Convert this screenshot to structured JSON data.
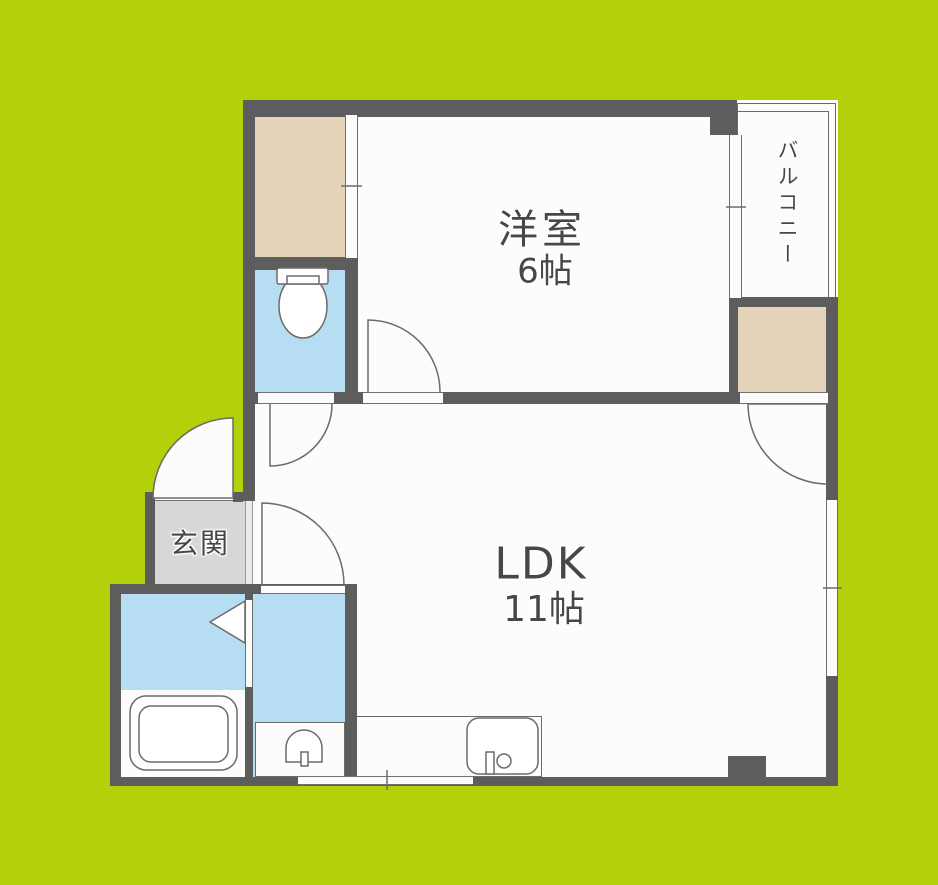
{
  "rooms": {
    "western": {
      "label": "洋室",
      "size": "6帖"
    },
    "ldk": {
      "label": "LDK",
      "size": "11帖"
    },
    "balcony": {
      "label": "バルコニー"
    },
    "entrance": {
      "label": "玄関"
    }
  },
  "fixtures": [
    "toilet",
    "bathtub",
    "washbasin",
    "kitchen-sink",
    "folding-bath-door",
    "hinged-doors",
    "sliding-closet-door",
    "sliding-windows"
  ],
  "colors": {
    "background": "#b3d00b",
    "wall": "#5d5d5d",
    "floor": "#fcfcfa",
    "water_rooms": "#b6ddf2",
    "closet": "#e6d4ba",
    "entrance_floor": "#d7d7d7",
    "outline": "#6b6b6b",
    "text": "#474747"
  }
}
